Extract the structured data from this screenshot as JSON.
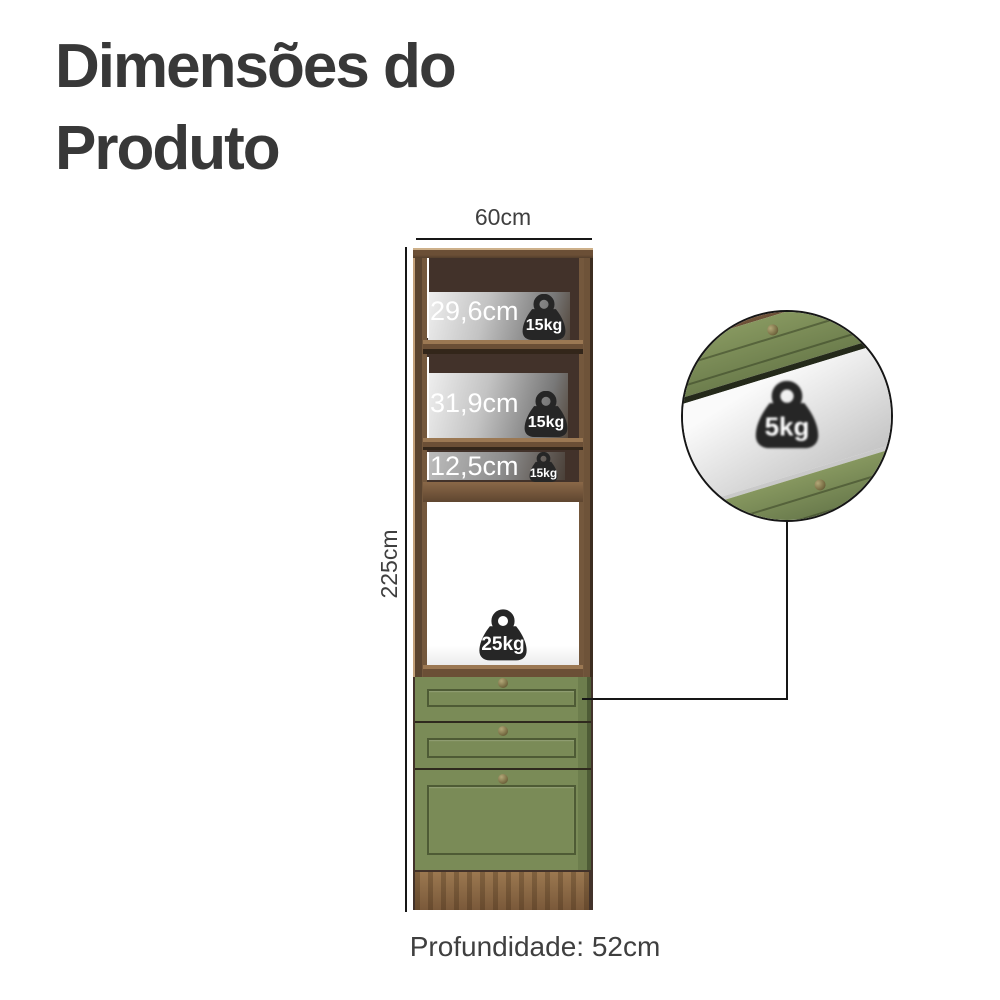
{
  "title": {
    "line1": "Dimensões do",
    "line2": "Produto"
  },
  "product": {
    "width_label": "60cm",
    "height_label": "225cm",
    "depth_label": "Profundidade: 52cm",
    "shelves": [
      {
        "size": "29,6cm",
        "capacity": "15kg"
      },
      {
        "size": "31,9cm",
        "capacity": "15kg"
      },
      {
        "size": "12,5cm",
        "capacity": "15kg"
      }
    ],
    "oven_compartment": {
      "capacity": "25kg"
    },
    "drawer_detail": {
      "capacity": "5kg"
    }
  },
  "colors": {
    "text-dark": "#383838",
    "label": "#3f3f3f",
    "line": "#161616",
    "badge": "#262626",
    "green": "#7a8b57",
    "green-dark": "#5f7040",
    "wood-frame": "#5d4833",
    "wood-light": "#c2a07a",
    "wood-base": "#8a6744",
    "interior": "#42322a"
  }
}
